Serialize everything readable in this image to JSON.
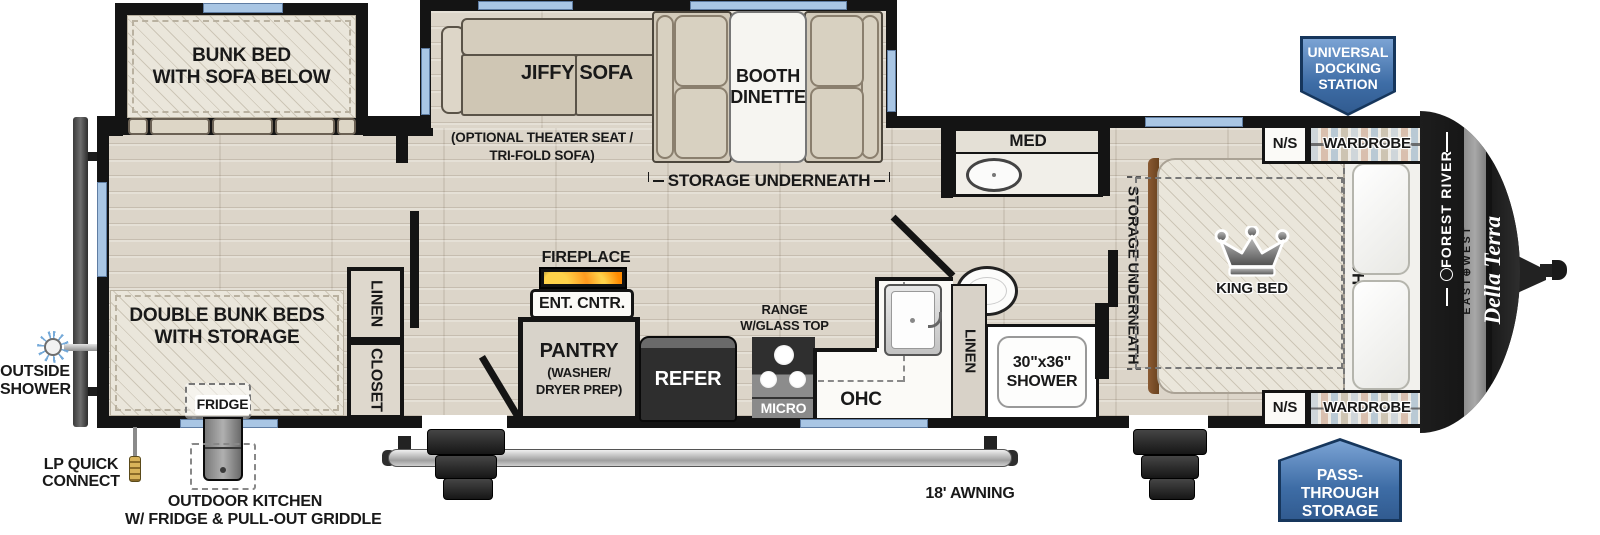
{
  "brand": {
    "maker": "FOREST RIVER",
    "series": "EAST⊕WEST",
    "model": "Della Terra"
  },
  "badges": {
    "docking_l1": "UNIVERSAL",
    "docking_l2": "DOCKING",
    "docking_l3": "STATION",
    "pass_l1": "PASS-THROUGH",
    "pass_l2": "STORAGE"
  },
  "exterior": {
    "awning": "18' AWNING",
    "outside_shower_l1": "OUTSIDE",
    "outside_shower_l2": "SHOWER",
    "lp_l1": "LP QUICK",
    "lp_l2": "CONNECT",
    "outdoor_kitchen_l1": "OUTDOOR KITCHEN",
    "outdoor_kitchen_l2": "W/ FRIDGE & PULL-OUT GRIDDLE"
  },
  "bunk_room": {
    "bunk_slide_l1": "BUNK BED",
    "bunk_slide_l2": "WITH SOFA BELOW",
    "double_bunks_l1": "DOUBLE BUNK BEDS",
    "double_bunks_l2": "WITH STORAGE",
    "fridge": "FRIDGE",
    "linen": "LINEN",
    "closet": "CLOSET"
  },
  "living": {
    "jiffy_sofa": "JIFFY SOFA",
    "optional_l1": "(OPTIONAL THEATER SEAT /",
    "optional_l2": "TRI-FOLD SOFA)",
    "dinette_l1": "BOOTH",
    "dinette_l2": "DINETTE",
    "dinette_storage": "STORAGE UNDERNEATH",
    "fireplace": "FIREPLACE",
    "ent_center": "ENT. CNTR.",
    "pantry": "PANTRY",
    "pantry_sub_l1": "(WASHER/",
    "pantry_sub_l2": "DRYER PREP)",
    "refer": "REFER",
    "range_l1": "RANGE",
    "range_l2": "W/GLASS TOP",
    "micro": "MICRO",
    "ohc": "OHC"
  },
  "bath": {
    "med": "MED",
    "linen": "LINEN",
    "shower_l1": "30\"x36\"",
    "shower_l2": "SHOWER"
  },
  "bedroom": {
    "under_bed_storage": "STORAGE UNDERNEATH",
    "king_bed": "KING BED",
    "ohc": "OHC",
    "ns": "N/S",
    "wardrobe": "WARDROBE"
  },
  "colors": {
    "badge_blue": "#3e6da6",
    "wall_black": "#141414",
    "window_blue": "#a9c6e4",
    "floor_tan": "#dcd5c9"
  }
}
